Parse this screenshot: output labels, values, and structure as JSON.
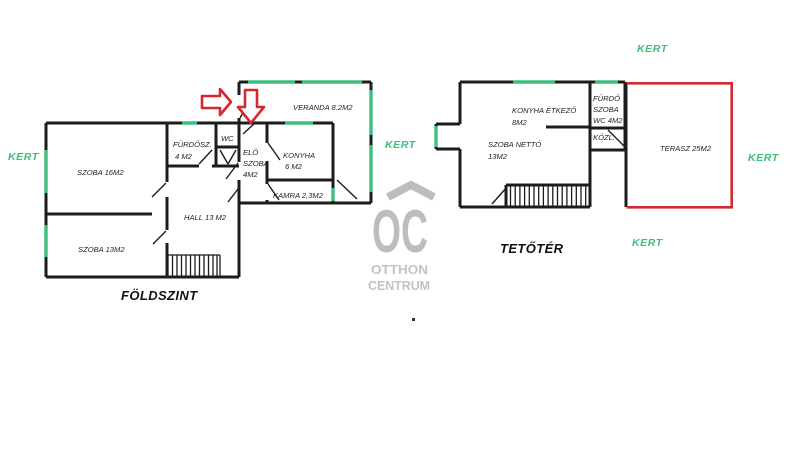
{
  "plans": {
    "ground": {
      "title": "FÖLDSZINT",
      "rooms": {
        "szoba16": "SZOBA 16M2",
        "szoba13": "SZOBA 13M2",
        "hall": "HALL 13 M2",
        "furdosz_line1": "FÜRDŐSZ.",
        "furdosz_line2": "4 M2",
        "wc": "WC",
        "elo_line1": "ELŐ",
        "elo_line2": "SZOBA",
        "elo_line3": "4M2",
        "konyha_line1": "KONYHA",
        "konyha_line2": "6 M2",
        "kamra": "KAMRA 2,3M2",
        "veranda": "VERANDA 8.2M2"
      },
      "kert_left": "KERT",
      "kert_right": "KERT"
    },
    "attic": {
      "title": "TETŐTÉR",
      "rooms": {
        "konyha_etkezo_line1": "KONYHA ÉTKEZŐ",
        "konyha_etkezo_line2": "8M2",
        "szoba_netto_line1": "SZOBA NETTÓ",
        "szoba_netto_line2": "13M2",
        "furdo_line1": "FÜRDŐ",
        "furdo_line2": "SZOBA",
        "furdo_line3": "WC 4M2",
        "kozl": "KÖZL.",
        "terasz": "TERASZ 25M2"
      },
      "kert_top": "KERT",
      "kert_right": "KERT",
      "kert_bottom": "KERT"
    }
  },
  "watermark": {
    "initials": "OC",
    "line1": "OTTHON",
    "line2": "CENTRUM"
  },
  "colors": {
    "wall": "#1c1c1c",
    "window_green": "#3fbd7d",
    "kert_green": "#3fbd7d",
    "accent_red": "#d4292f",
    "watermark_gray": "#bdbdbd"
  }
}
